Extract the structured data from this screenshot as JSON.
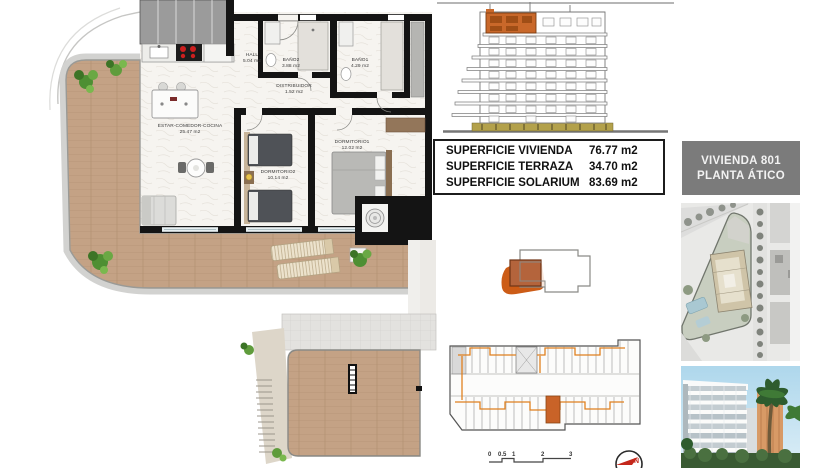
{
  "document": {
    "type": "apartment floor plan sheet"
  },
  "floor_plan": {
    "rooms": [
      {
        "name": "HALL",
        "area": "5.04 m2"
      },
      {
        "name": "BAÑO2",
        "area": "3.88 m2"
      },
      {
        "name": "BAÑO1",
        "area": "4.29 m2"
      },
      {
        "name": "DISTRIBUIDOR",
        "area": "1.52 m2"
      },
      {
        "name": "ESTAR-COMEDOR-COCINA",
        "area": "25.47 m2"
      },
      {
        "name": "DORMITORIO2",
        "area": "10.14 m2"
      },
      {
        "name": "DORMITORIO1",
        "area": "12.02 m2"
      }
    ]
  },
  "surface_table": {
    "rows": [
      {
        "label": "SUPERFICIE VIVIENDA",
        "value": "76.77 m2"
      },
      {
        "label": "SUPERFICIE TERRAZA",
        "value": "34.70 m2"
      },
      {
        "label": "SUPERFICIE SOLARIUM",
        "value": "83.69 m2"
      }
    ]
  },
  "unit_label": {
    "line1": "VIVIENDA 801",
    "line2": "PLANTA ÁTICO"
  },
  "scale_bar": {
    "ticks": [
      "0",
      "0.5",
      "1",
      "2",
      "3"
    ]
  },
  "north_indicator": {
    "label": "N"
  },
  "colors": {
    "highlight_orange": "#c9682a",
    "keyplan_orange": "#cc5c17",
    "unit_brown": "#b4643c",
    "terrace_wood": "#c4a285",
    "elevation_base": "#b3a14b",
    "label_box_bg": "#7b7b7b",
    "north_red": "#c4271b"
  }
}
